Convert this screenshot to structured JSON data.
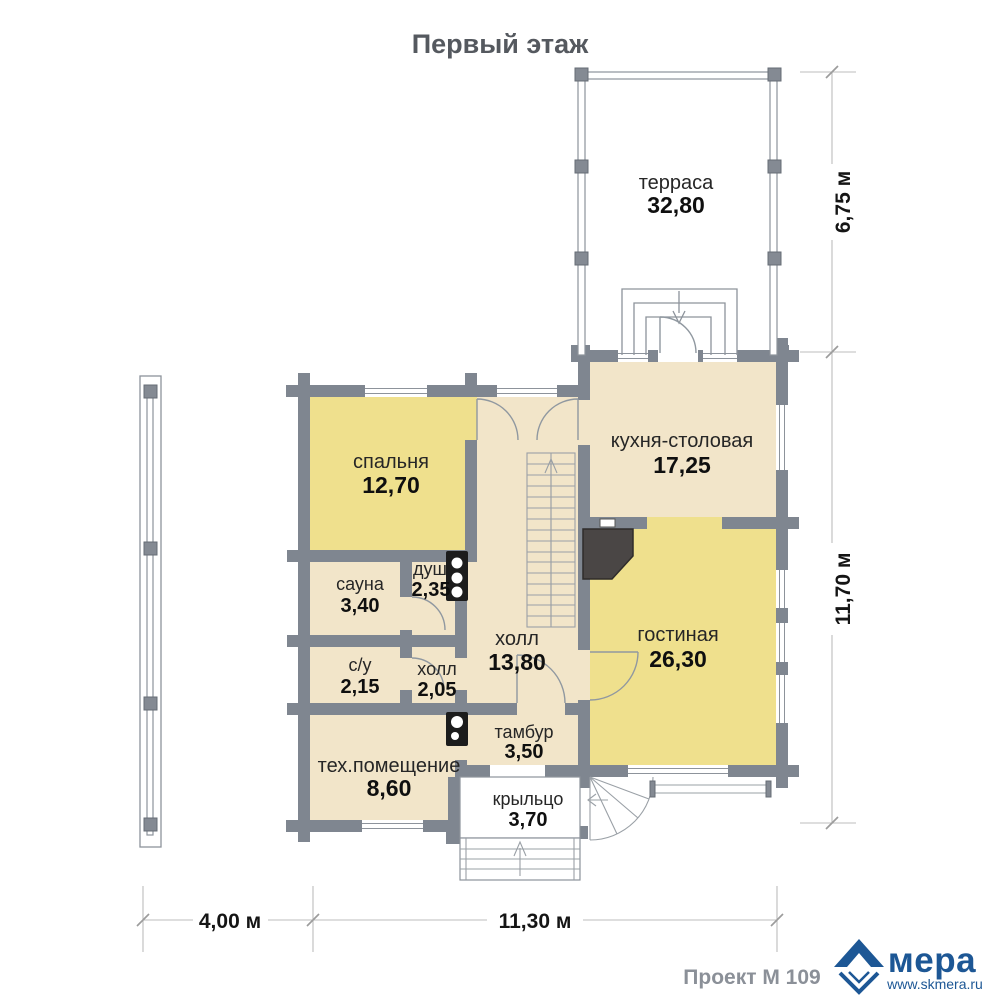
{
  "title": "Первый этаж",
  "rooms": [
    {
      "name": "терраса",
      "area": "32,80"
    },
    {
      "name": "спальня",
      "area": "12,70"
    },
    {
      "name": "кухня-столовая",
      "area": "17,25"
    },
    {
      "name": "сауна",
      "area": "3,40"
    },
    {
      "name": "душ",
      "area": "2,35"
    },
    {
      "name": "холл",
      "area": "13,80"
    },
    {
      "name": "гостиная",
      "area": "26,30"
    },
    {
      "name": "с/у",
      "area": "2,15"
    },
    {
      "name": "холл",
      "area": "2,05"
    },
    {
      "name": "тамбур",
      "area": "3,50"
    },
    {
      "name": "тех.помещение",
      "area": "8,60"
    },
    {
      "name": "крыльцо",
      "area": "3,70"
    }
  ],
  "dimensions": {
    "terrace_height": "6,75 м",
    "house_height": "11,70 м",
    "pergola_width": "4,00 м",
    "house_width": "11,30 м"
  },
  "footer": {
    "project": "Проект М 109",
    "brand": "мера",
    "website": "www.skmera.ru"
  },
  "colors": {
    "wall_gray": "#7f8690",
    "room_yellow": "#efe08d",
    "room_beige": "#f2e5c9",
    "logo_blue": "#1d5795"
  }
}
